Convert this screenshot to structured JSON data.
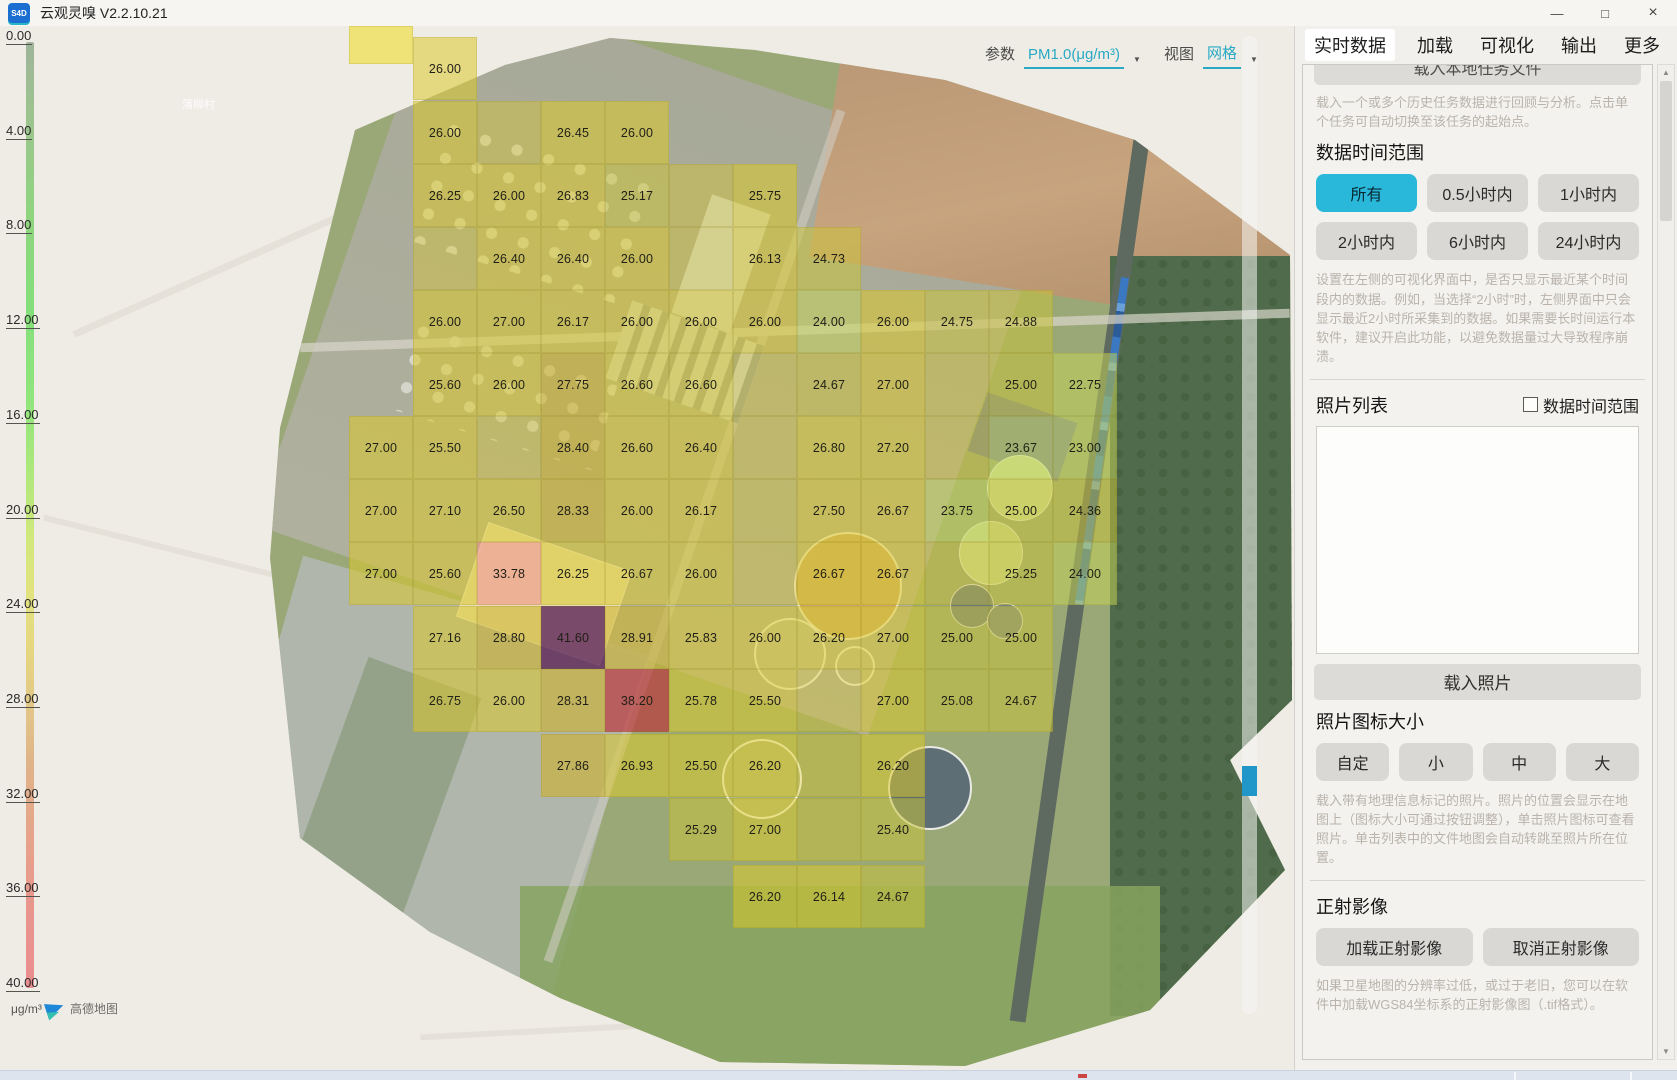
{
  "window": {
    "title": "云观灵嗅 V2.2.10.21",
    "logo_text": "S4D",
    "minimize_glyph": "—",
    "maximize_glyph": "□",
    "close_glyph": "×"
  },
  "map": {
    "toolbar": {
      "param_label": "参数",
      "param_value": "PM1.0(μg/m³)",
      "view_label": "视图",
      "view_value": "网格",
      "dropdown_glyph": "▼"
    },
    "village_label": "蒲柳村",
    "attribution_text": "高德地图",
    "scale": {
      "unit": "μg/m³",
      "ticks": [
        "0.00",
        "4.00",
        "8.00",
        "12.00",
        "16.00",
        "20.00",
        "24.00",
        "28.00",
        "32.00",
        "36.00",
        "40.00"
      ],
      "min": 0,
      "max": 40
    },
    "accent_colors": {
      "teal": "#2aa9c4",
      "slider_blue": "#2196c9"
    },
    "grid": {
      "columns_x": [
        381,
        445,
        509,
        573,
        637,
        701,
        765,
        829,
        893,
        957,
        1021,
        1085
      ],
      "rows_y": [
        69,
        133,
        196,
        259,
        322,
        385,
        448,
        511,
        574,
        638,
        701,
        766,
        830,
        897
      ],
      "cells": [
        "0,1,26.00",
        "1,1,26.00",
        "1,3,26.45",
        "1,4,26.00",
        "2,1,26.25",
        "2,2,26.00",
        "2,3,26.83",
        "2,4,25.17",
        "2,6,25.75",
        "3,2,26.40",
        "3,3,26.40",
        "3,4,26.00",
        "3,6,26.13",
        "3,7,24.73",
        "4,1,26.00",
        "4,2,27.00",
        "4,3,26.17",
        "4,4,26.00",
        "4,5,26.00",
        "4,6,26.00",
        "4,7,24.00",
        "4,8,26.00",
        "4,9,24.75",
        "4,10,24.88",
        "5,1,25.60",
        "5,2,26.00",
        "5,3,27.75",
        "5,4,26.60",
        "5,5,26.60",
        "5,7,24.67",
        "5,8,27.00",
        "5,10,25.00",
        "5,11,22.75",
        "6,0,27.00",
        "6,1,25.50",
        "6,3,28.40",
        "6,4,26.60",
        "6,5,26.40",
        "6,7,26.80",
        "6,8,27.20",
        "6,10,23.67",
        "6,11,23.00",
        "7,0,27.00",
        "7,1,27.10",
        "7,2,26.50",
        "7,3,28.33",
        "7,4,26.00",
        "7,5,26.17",
        "7,7,27.50",
        "7,8,26.67",
        "7,9,23.75",
        "7,10,25.00",
        "7,11,24.36",
        "8,0,27.00",
        "8,1,25.60",
        "8,2,33.78",
        "8,3,26.25",
        "8,4,26.67",
        "8,5,26.00",
        "8,7,26.67",
        "8,8,26.67",
        "8,10,25.25",
        "8,11,24.00",
        "9,1,27.16",
        "9,2,28.80",
        "9,3,41.60",
        "9,4,28.91",
        "9,5,25.83",
        "9,6,26.00",
        "9,7,26.20",
        "9,8,27.00",
        "9,9,25.00",
        "9,10,25.00",
        "10,1,26.75",
        "10,2,26.00",
        "10,3,28.31",
        "10,4,38.20",
        "10,5,25.78",
        "10,6,25.50",
        "10,8,27.00",
        "10,9,25.08",
        "10,10,24.67",
        "11,3,27.86",
        "11,4,26.93",
        "11,5,25.50",
        "11,6,26.20",
        "11,8,26.20",
        "12,5,25.29",
        "12,6,27.00",
        "12,8,25.40",
        "13,6,26.20",
        "13,7,26.14",
        "13,8,24.67"
      ],
      "ghost_cells": [
        "1,2",
        "2,5",
        "3,1",
        "3,5",
        "5,6",
        "5,9",
        "6,2",
        "6,6",
        "6,9",
        "7,6",
        "8,6",
        "8,9",
        "10,7",
        "11,7",
        "12,7"
      ]
    }
  },
  "panel": {
    "tabs": {
      "items": [
        "实时数据",
        "加载",
        "可视化",
        "输出",
        "更多"
      ],
      "active": "加载",
      "highlighted_chip": "实时数据"
    },
    "load_task": {
      "button": "载入本地任务文件",
      "desc": "载入一个或多个历史任务数据进行回顾与分析。点击单个任务可自动切换至该任务的起始点。"
    },
    "time_range": {
      "title": "数据时间范围",
      "options": [
        "所有",
        "0.5小时内",
        "1小时内",
        "2小时内",
        "6小时内",
        "24小时内"
      ],
      "selected": "所有",
      "desc": "设置在左侧的可视化界面中，是否只显示最近某个时间段内的数据。例如，当选择“2小时”时，左侧界面中只会显示最近2小时所采集到的数据。如果需要长时间运行本软件，建议开启此功能，以避免数据量过大导致程序崩溃。"
    },
    "photos": {
      "title": "照片列表",
      "checkbox_label": "数据时间范围",
      "checkbox_checked": false,
      "list_items": [],
      "load_button": "载入照片",
      "icon_size_title": "照片图标大小",
      "icon_size_options": [
        "自定",
        "小",
        "中",
        "大"
      ],
      "desc": "载入带有地理信息标记的照片。照片的位置会显示在地图上（图标大小可通过按钮调整），单击照片图标可查看照片。单击列表中的文件地图会自动转跳至照片所在位置。"
    },
    "ortho": {
      "title": "正射影像",
      "load_button": "加载正射影像",
      "cancel_button": "取消正射影像",
      "desc": "如果卫星地图的分辨率过低，或过于老旧，您可以在软件中加载WGS84坐标系的正射影像图（.tif格式）。"
    }
  }
}
